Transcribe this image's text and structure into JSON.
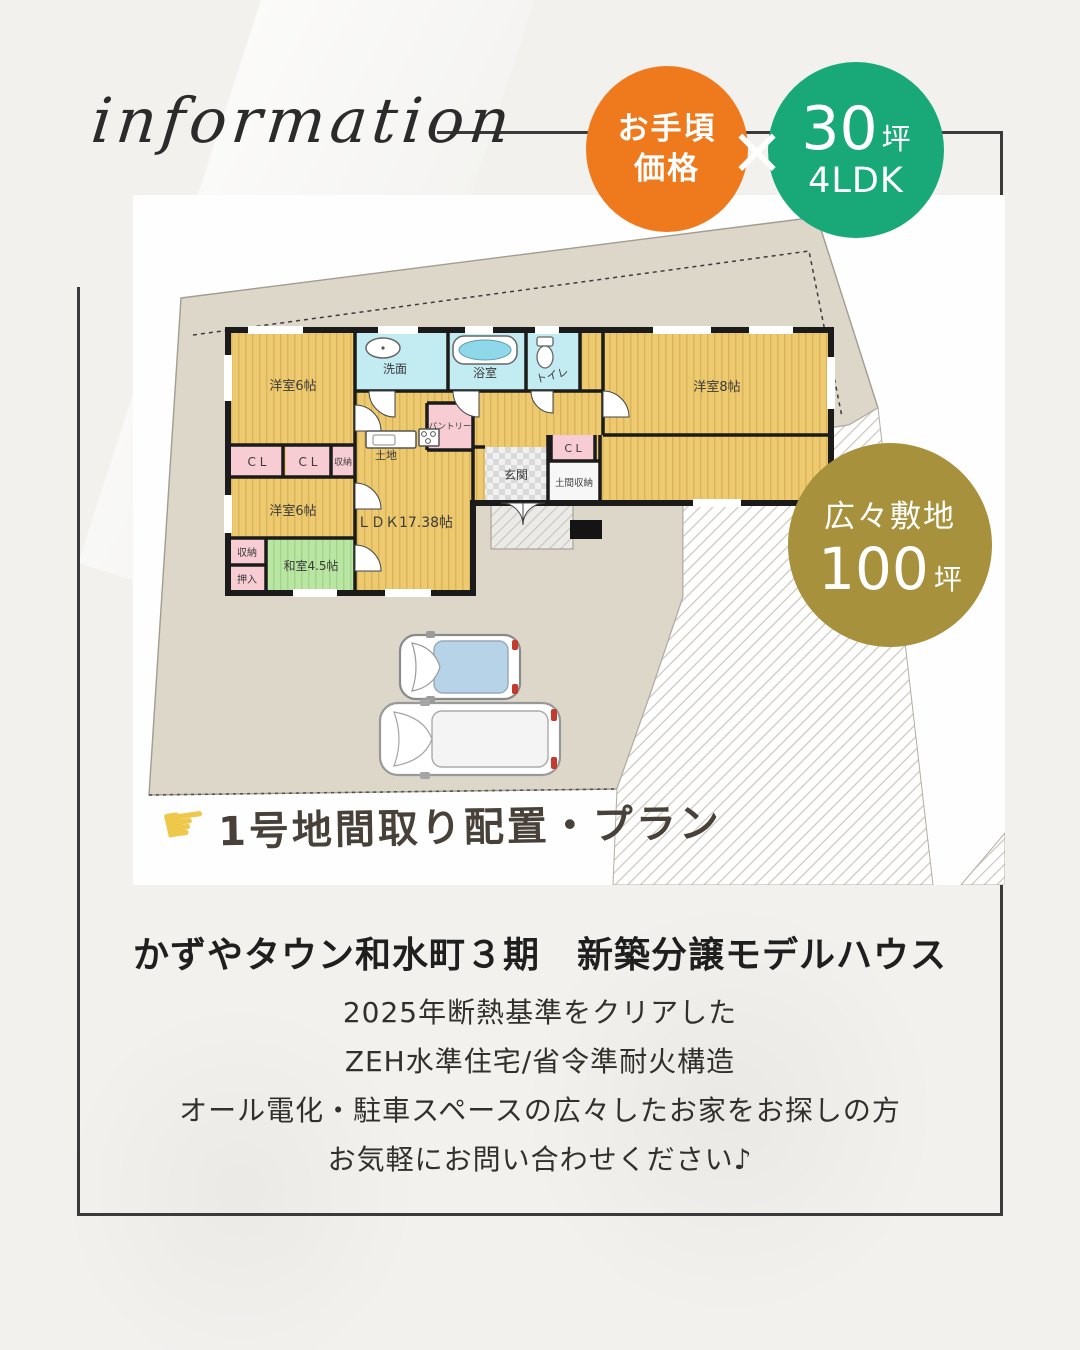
{
  "header": {
    "script_label": "information"
  },
  "badges": {
    "orange": {
      "line1": "お手頃",
      "line2": "価格"
    },
    "times_mark": "×",
    "green": {
      "value": "30",
      "unit": "坪",
      "subtitle": "4LDK"
    },
    "gold": {
      "title": "広々敷地",
      "value": "100",
      "unit": "坪"
    }
  },
  "colors": {
    "accent_orange": "#ef7a1e",
    "accent_green": "#19a878",
    "accent_gold": "#a8913c",
    "plot_beige": "#ddd7ca",
    "room_yellow": "#edc96f",
    "room_cyan": "#c3ecf2",
    "room_pink": "#f7cdd3",
    "tatami_green": "#b9e6a2",
    "wall_black": "#1b1b1b"
  },
  "floorplan": {
    "caption": {
      "hand_glyph": "☛",
      "text": "1号地間取り配置・プラン"
    },
    "rooms": {
      "yoshitsu6_a": "洋室6帖",
      "senmen": "洗面",
      "yokushitsu": "浴室",
      "toire": "トイレ",
      "yoshitsu8": "洋室8帖",
      "cl_1": "C L",
      "cl_2": "C L",
      "shuno_top": "収納",
      "yoshitsu6_b": "洋室6帖",
      "shuno_left": "収納",
      "oshiire": "押入",
      "washitsu": "和室4.5帖",
      "ldk": "ＬＤＫ17.38帖",
      "doma": "土地",
      "pantry": "パントリー",
      "genkan": "玄関",
      "doma_shuno": "土間収納",
      "cl_3": "C L"
    }
  },
  "body": {
    "heading": "かずやタウン和水町３期　新築分譲モデルハウス",
    "lines": [
      "2025年断熱基準をクリアした",
      "ZEH水準住宅/省令準耐火構造",
      "オール電化・駐車スペースの広々したお家をお探しの方",
      "お気軽にお問い合わせください♪"
    ]
  }
}
